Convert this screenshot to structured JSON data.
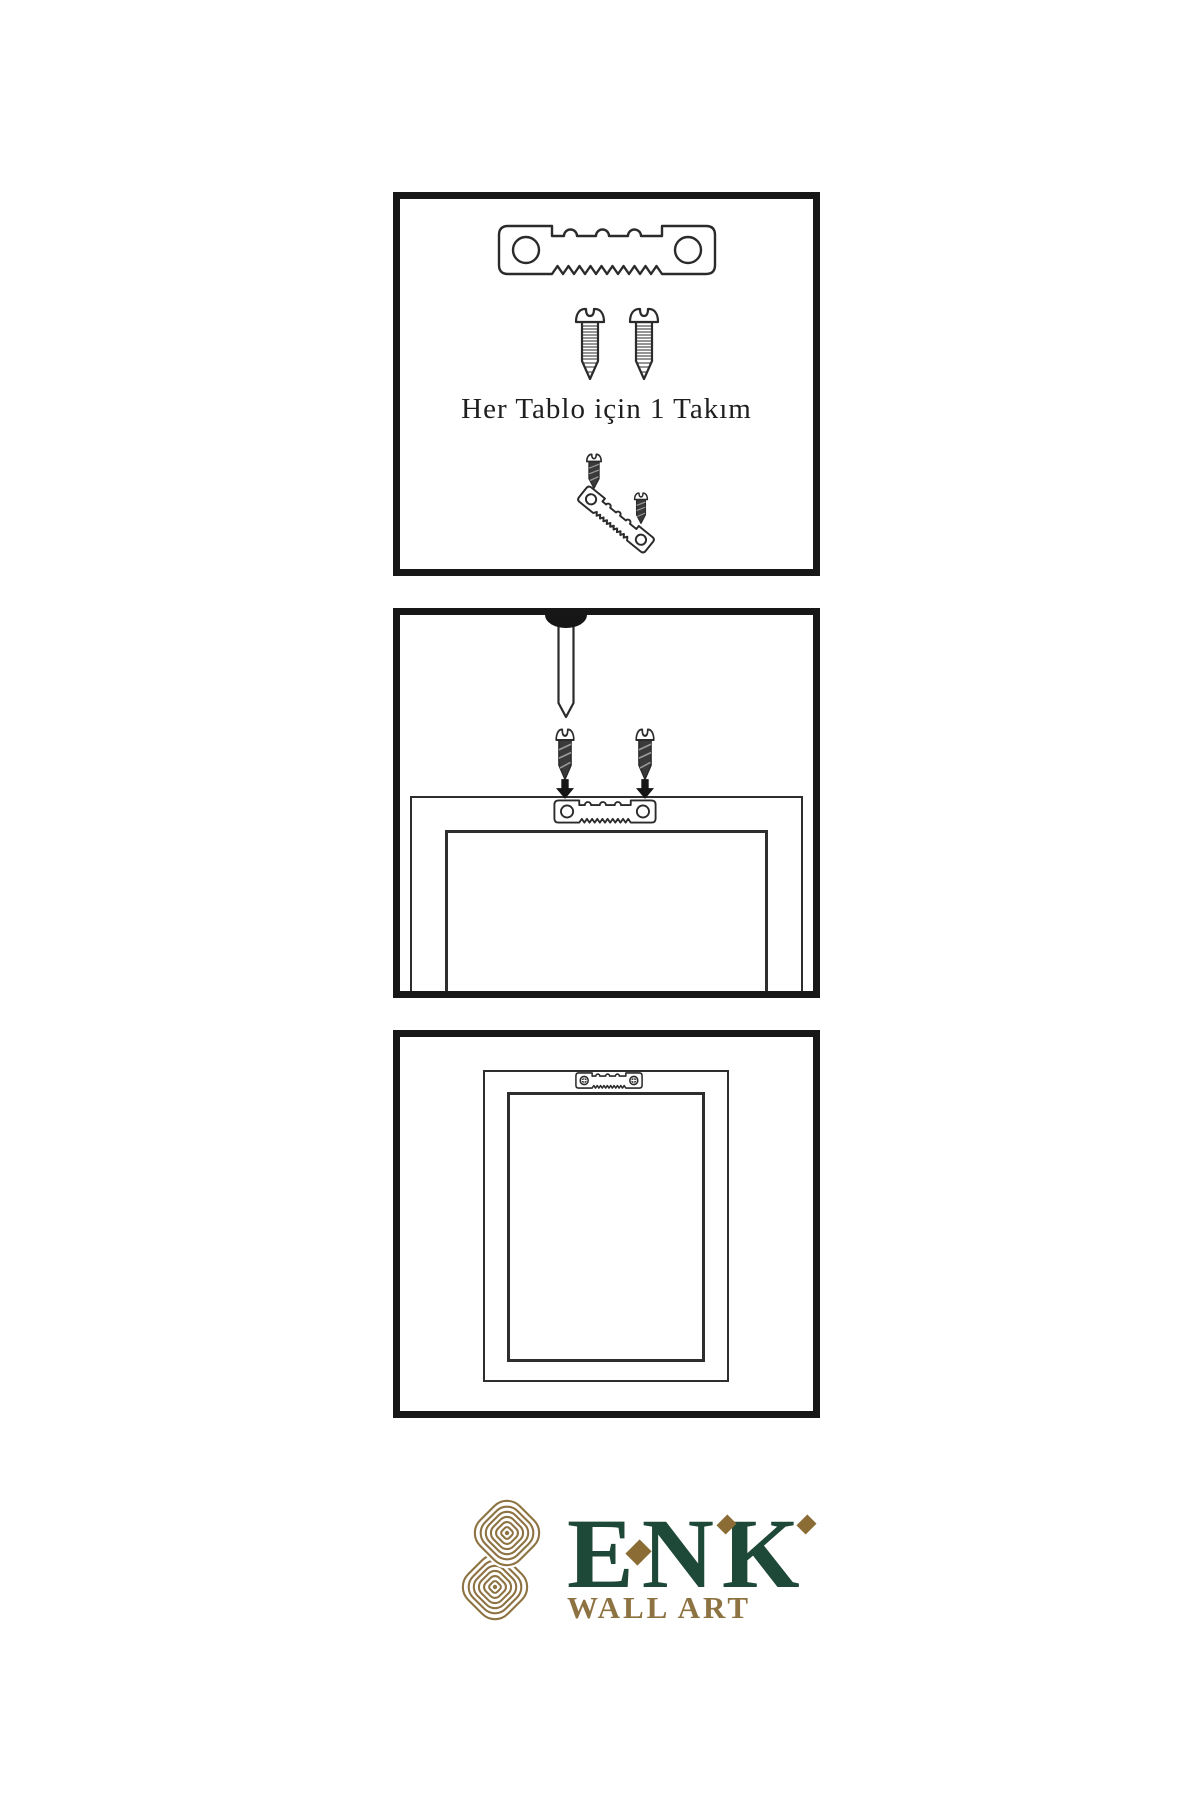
{
  "page": {
    "background": "#ffffff"
  },
  "colors": {
    "bg": "#ffffff",
    "panel_border": "#171717",
    "outline": "#2b2b2b",
    "dark_screw": "#3a3a3a",
    "hatch": "#9b9b9b",
    "text": "#1f1f1f",
    "brand_green": "#1e4837",
    "brand_gold": "#8e7342",
    "diamond_gold": "#8a6c34"
  },
  "steps": [
    {
      "name": "hardware-kit",
      "caption": "Her Tablo için 1 Takım",
      "icons": [
        "sawtooth-hanger-icon",
        "screw-icon",
        "screw-icon",
        "dark-screw-icon",
        "tilted-sawtooth-hanger-icon",
        "dark-screw-icon"
      ]
    },
    {
      "name": "mount-hanger-on-frame",
      "icons": [
        "nail-icon",
        "dark-screw-icon",
        "dark-screw-icon",
        "arrow-down-icon",
        "arrow-down-icon",
        "frame-back-icon",
        "sawtooth-hanger-icon"
      ]
    },
    {
      "name": "hang-frame-on-wall",
      "icons": [
        "frame-back-icon",
        "mounted-sawtooth-hanger-icon"
      ]
    }
  ],
  "brand": {
    "name": "ENK",
    "subtitle": "WALL ART",
    "logo": "knot-logo"
  }
}
